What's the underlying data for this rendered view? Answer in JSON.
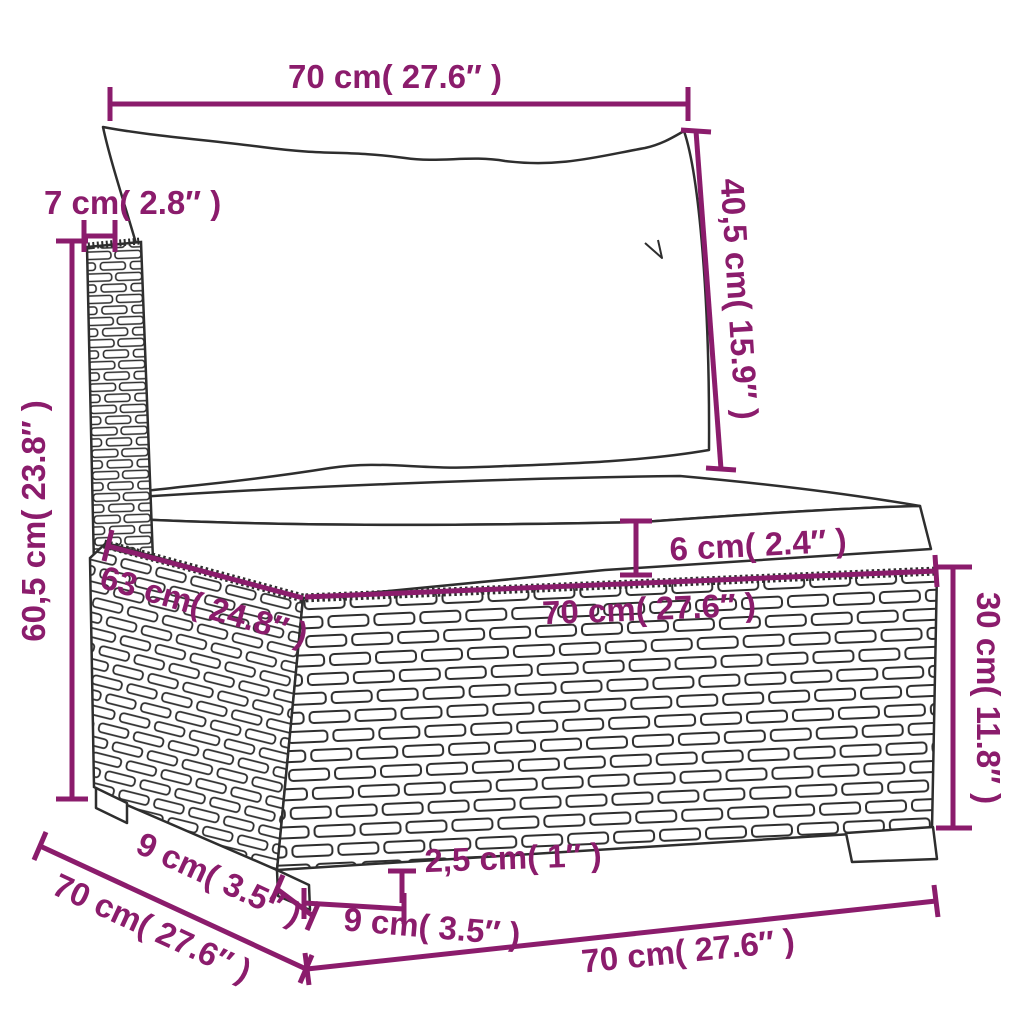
{
  "diagram": {
    "accent_color": "#8b1c6c",
    "line_color": "#2e2e2e",
    "background_color": "#ffffff",
    "dims": [
      {
        "id": "cushion-top-width",
        "label": "70 cm( 27.6″ )"
      },
      {
        "id": "back-cushion-height",
        "label": "40,5 cm( 15.9″ )"
      },
      {
        "id": "back-post-width",
        "label": "7 cm( 2.8″ )"
      },
      {
        "id": "overall-height",
        "label": "60,5 cm( 23.8″ )"
      },
      {
        "id": "seat-cushion-thickness",
        "label": "6 cm( 2.4″ )"
      },
      {
        "id": "seat-front-width",
        "label": "70 cm( 27.6″ )"
      },
      {
        "id": "seat-depth",
        "label": "63 cm( 24.8″ )"
      },
      {
        "id": "base-height",
        "label": "30 cm( 11.8″ )"
      },
      {
        "id": "side-depth",
        "label": "70 cm( 27.6″ )"
      },
      {
        "id": "leg-depth",
        "label": "9 cm( 3.5″ )"
      },
      {
        "id": "leg-height",
        "label": "2,5 cm( 1″ )"
      },
      {
        "id": "leg-width",
        "label": "9 cm( 3.5″ )"
      },
      {
        "id": "base-front-width",
        "label": "70 cm( 27.6″ )"
      }
    ]
  }
}
